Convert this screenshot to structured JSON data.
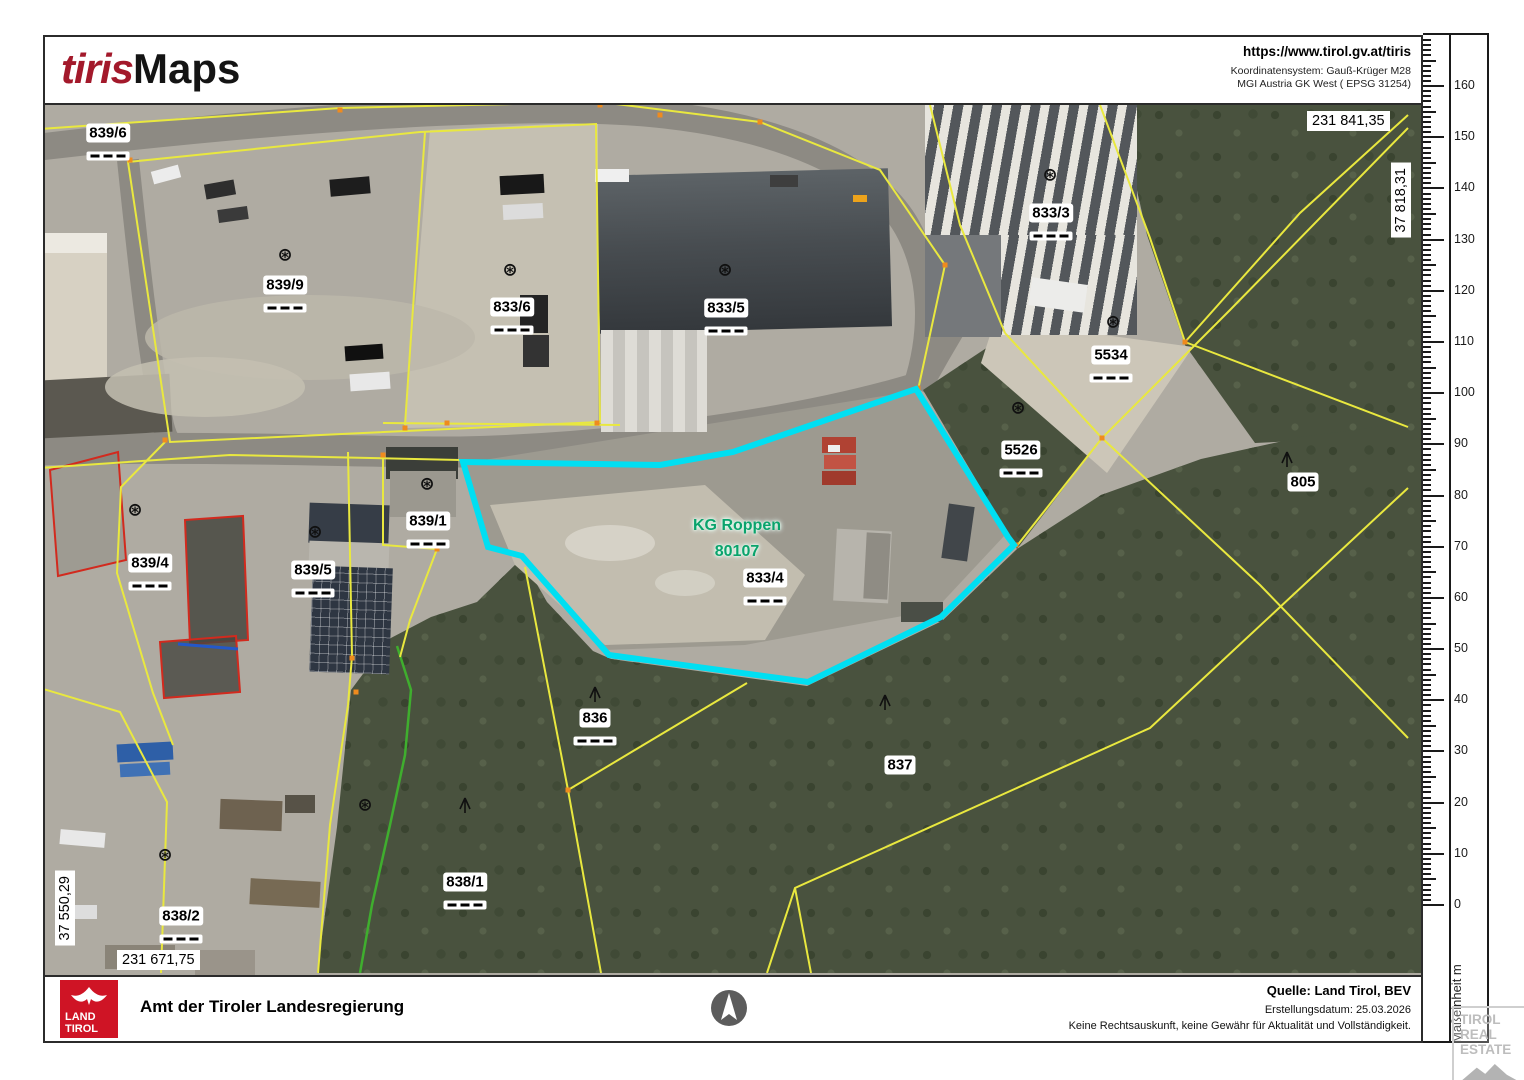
{
  "header": {
    "logo_tiris": "tiris",
    "logo_maps": "Maps",
    "url": "https://www.tirol.gv.at/tiris",
    "coord_system_line1": "Koordinatensystem: Gauß-Krüger M28",
    "coord_system_line2": "MGI Austria GK West ( EPSG 31254)"
  },
  "map": {
    "corner_coords": {
      "top_x": "231 841,35",
      "top_y": "37 818,31",
      "bottom_y": "37 550,29",
      "bottom_x": "231 671,75"
    },
    "kg_label": {
      "line1": "KG Roppen",
      "line2": "80107"
    },
    "parcel_labels": [
      {
        "text": "839/6"
      },
      {
        "text": "839/9"
      },
      {
        "text": "833/6"
      },
      {
        "text": "833/5"
      },
      {
        "text": "833/3"
      },
      {
        "text": "5534"
      },
      {
        "text": "5526"
      },
      {
        "text": "805"
      },
      {
        "text": "839/1"
      },
      {
        "text": "839/4"
      },
      {
        "text": "839/5"
      },
      {
        "text": "833/4"
      },
      {
        "text": "836"
      },
      {
        "text": "837"
      },
      {
        "text": "838/1"
      },
      {
        "text": "838/2"
      }
    ],
    "symbols": {
      "cadastral": "⊛"
    },
    "highlight_color": "#00dff2",
    "boundary_color": "#e9e83f"
  },
  "ruler": {
    "labels": [
      "0",
      "10",
      "20",
      "30",
      "40",
      "50",
      "60",
      "70",
      "80",
      "90",
      "100",
      "110",
      "120",
      "130",
      "140",
      "150",
      "160"
    ],
    "unit_label": "Maßeinheit m"
  },
  "footer": {
    "logo_line1": "LAND",
    "logo_line2": "TIROL",
    "org": "Amt der Tiroler Landesregierung",
    "source": "Quelle: Land Tirol, BEV",
    "date": "Erstellungsdatum:  25.03.2026",
    "disclaimer": "Keine Rechtsauskunft, keine Gewähr für Aktualität und Vollständigkeit."
  },
  "watermark": {
    "line1": "TIROL",
    "line2": "REAL",
    "line3": "ESTATE"
  }
}
